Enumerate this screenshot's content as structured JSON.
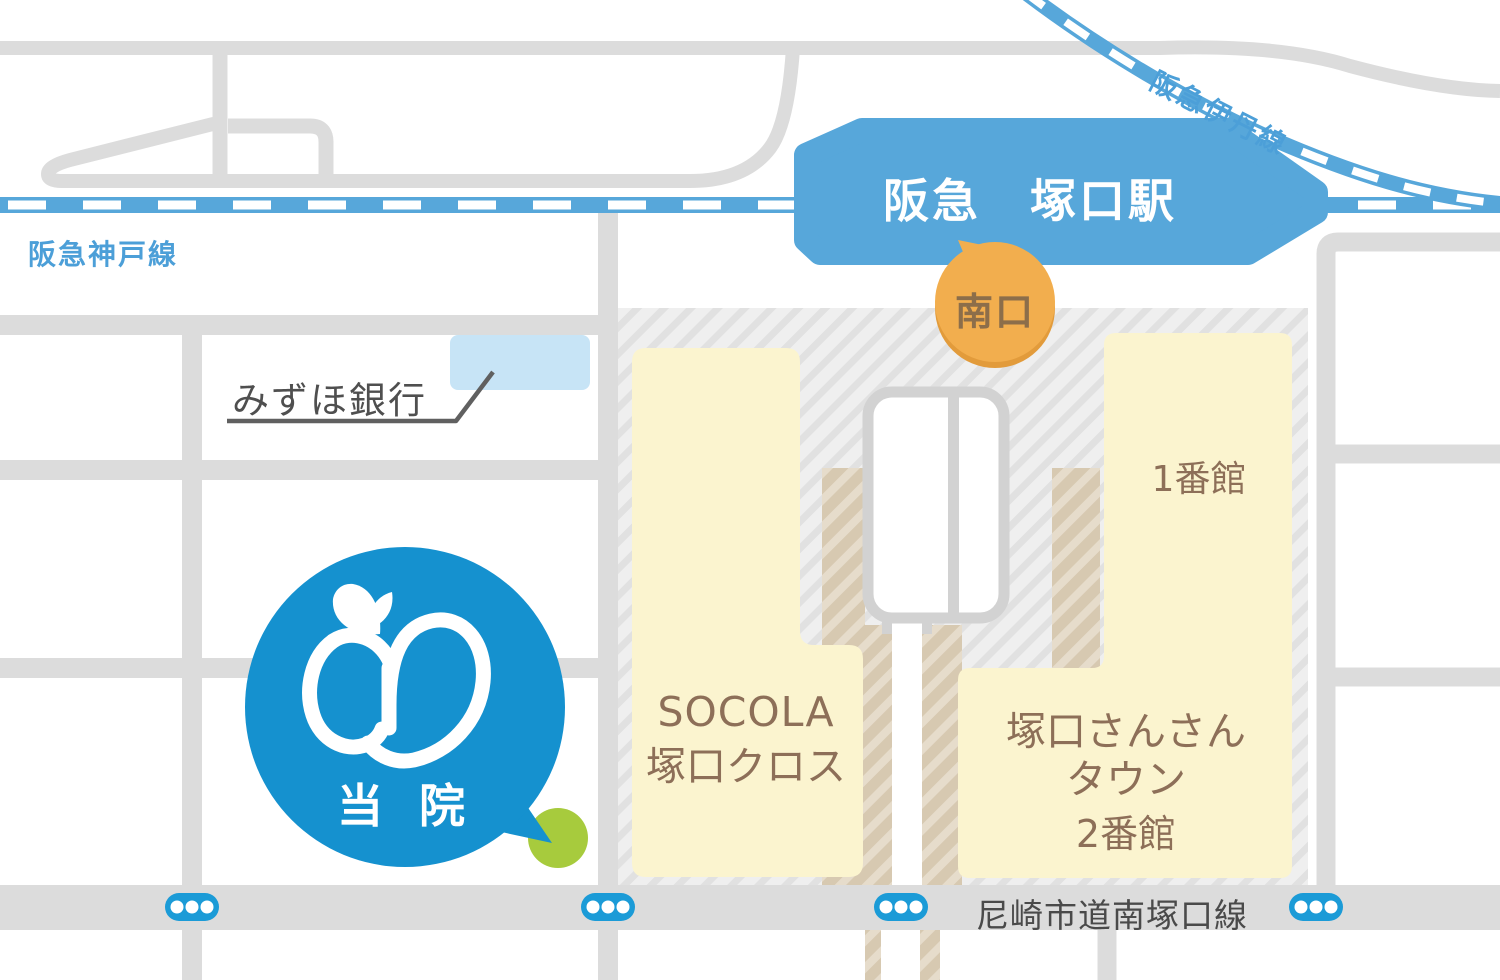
{
  "railways": {
    "kobe_line": "阪急神戸線",
    "itami_line": "阪急伊丹線"
  },
  "station": {
    "name": "阪急　塚口駅",
    "south_exit": "南口"
  },
  "landmarks": {
    "bank": "みずほ銀行",
    "socola_line1": "SOCOLA",
    "socola_line2": "塚口クロス",
    "bldg1": "1番館",
    "sansan_line1": "塚口さんさん",
    "sansan_line2": "タウン",
    "sansan_line3": "2番館"
  },
  "clinic": {
    "label": "当 院"
  },
  "road": {
    "name": "尼崎市道南塚口線"
  },
  "colors": {
    "rail_blue": "#57a7da",
    "clinic_blue": "#1591cf",
    "road_gray": "#dcdcdc",
    "building_yellow": "#fbf4cf",
    "building_text_brown": "#8d6f58",
    "exit_orange": "#f2ae4e",
    "exit_text_brown": "#8c6e4a",
    "marker_green": "#a7cb3d",
    "bank_light_blue": "#c7e4f6",
    "signal_blue": "#1b9bd7"
  }
}
